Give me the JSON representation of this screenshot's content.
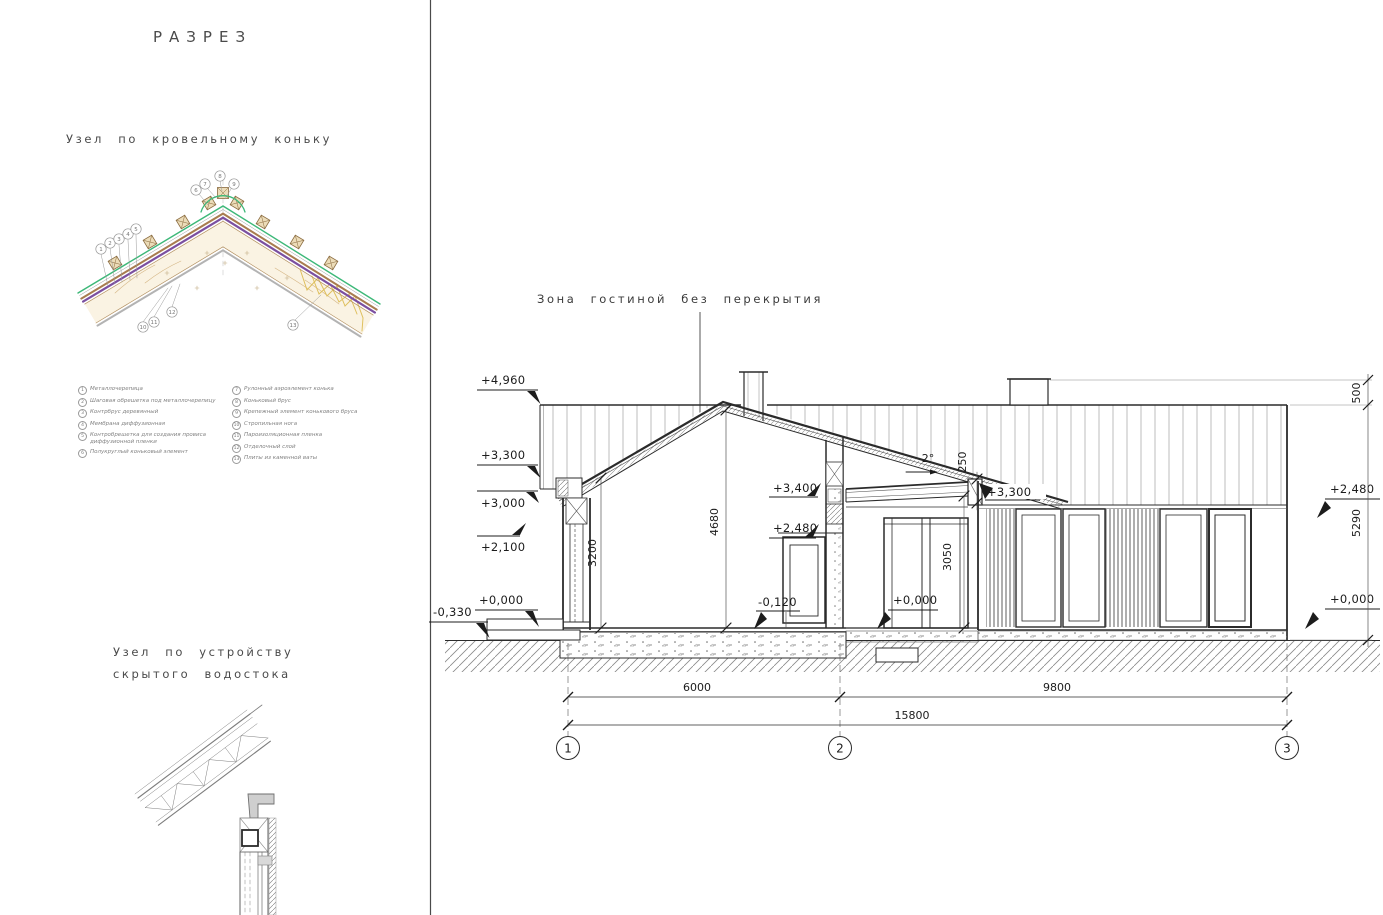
{
  "titles": {
    "main": "РАЗРЕЗ",
    "ridge": "Узел по кровельному коньку",
    "gutter1": "Узел по устройству",
    "gutter2": "скрытого водостока",
    "annotation": "Зона гостиной без перекрытия"
  },
  "legend": {
    "left": [
      {
        "n": "1",
        "t": "Металлочерепица"
      },
      {
        "n": "2",
        "t": "Шаговая обрешетка под металлочерепицу"
      },
      {
        "n": "3",
        "t": "Контрбрус деревянный"
      },
      {
        "n": "4",
        "t": "Мембрана диффузионная"
      },
      {
        "n": "5",
        "t": "Контробрешетка для создания провиса диффузионной пленки"
      },
      {
        "n": "6",
        "t": "Полукруглый коньковый элемент"
      }
    ],
    "right": [
      {
        "n": "7",
        "t": "Рулонный аэроэлемент конька"
      },
      {
        "n": "8",
        "t": "Коньковый брус"
      },
      {
        "n": "9",
        "t": "Крепежный элемент конькового бруса"
      },
      {
        "n": "10",
        "t": "Стропильная нога"
      },
      {
        "n": "11",
        "t": "Пароизоляционная пленка"
      },
      {
        "n": "12",
        "t": "Отделочный слой"
      },
      {
        "n": "13",
        "t": "Плиты из каменной ваты"
      }
    ]
  },
  "section": {
    "marks": {
      "left": [
        "+4,960",
        "+3,300",
        "+3,000",
        "+2,100",
        "+0,000",
        "-0,330"
      ],
      "middle": [
        "+3,400",
        "+2,480",
        "-0,120",
        "+0,000"
      ],
      "right": [
        "+3,300",
        "+2,480",
        "+0,000"
      ]
    },
    "dims": {
      "h4680": "4680",
      "w3200": "3200",
      "h3050": "3050",
      "t250": "250",
      "slope": "2°",
      "p500": "500",
      "r5290": "5290",
      "d6000": "6000",
      "d9800": "9800",
      "d15800": "15800"
    },
    "axes": [
      "1",
      "2",
      "3"
    ]
  },
  "colors": {
    "metal_tile_green": "#3cb878",
    "membrane_purple": "#7b4fa0",
    "wood_brown": "#a87c4f",
    "insulation_yellow": "#e0c060"
  }
}
